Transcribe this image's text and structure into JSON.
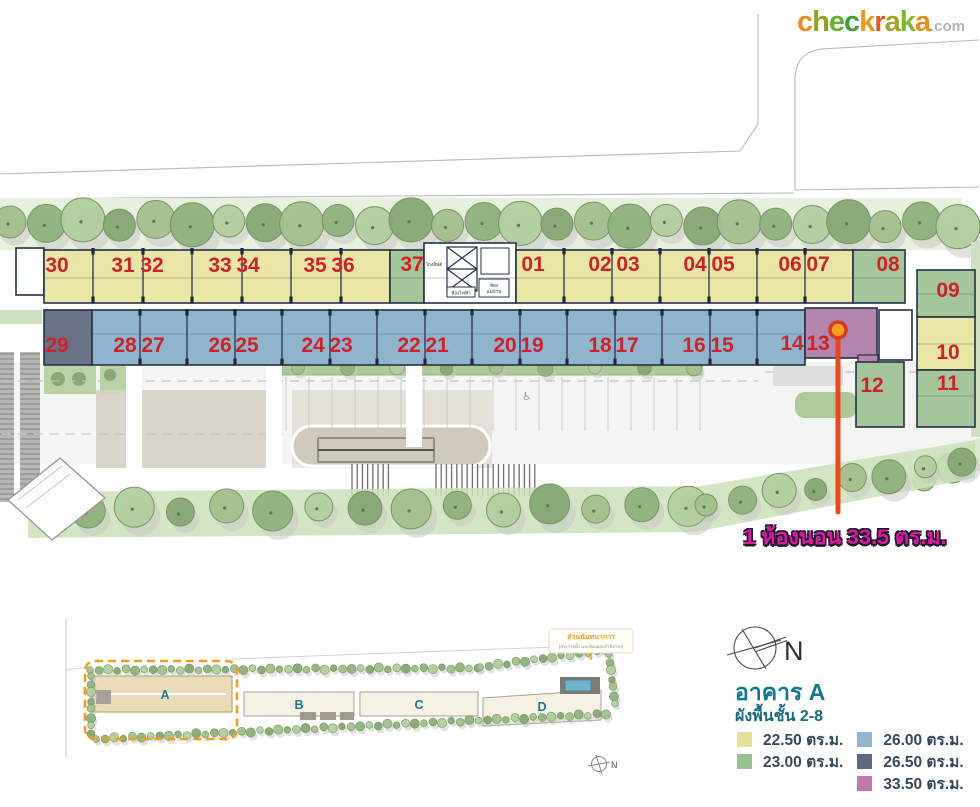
{
  "logo": {
    "letters": [
      "c",
      "h",
      "e",
      "c",
      "k",
      "r",
      "a",
      "k",
      "a"
    ],
    "suffix": ".com",
    "letter_colors": [
      "#ef8c1e",
      "#8fa31f",
      "#64b32a",
      "#3f9e3a",
      "#f0951c",
      "#e25a17",
      "#9aa822",
      "#7db82b",
      "#ee8d1c"
    ],
    "suffix_color": "#b5b5b5"
  },
  "plan": {
    "top_row_units": [
      "30",
      "31",
      "32",
      "33",
      "34",
      "35",
      "36",
      "37",
      "01",
      "02",
      "03",
      "04",
      "05",
      "06",
      "07",
      "08"
    ],
    "bottom_row_units": [
      "29",
      "28",
      "27",
      "26",
      "25",
      "24",
      "23",
      "22",
      "21",
      "20",
      "19",
      "18",
      "17",
      "16",
      "15",
      "14",
      "13"
    ],
    "right_units": [
      "09",
      "10",
      "11",
      "12"
    ],
    "core_labels": {
      "elevator_hall": "โถงลิฟต์",
      "electrical_room": "ห้องไฟฟ้า",
      "maid_room_line1": "ห้อง",
      "maid_room_line2": "แม่บ้าน"
    },
    "number_color": "#cf2127",
    "unit_sizes": {
      "22.50": [
        "30",
        "31",
        "32",
        "33",
        "34",
        "35",
        "36",
        "01",
        "02",
        "03",
        "04",
        "05",
        "06",
        "07",
        "10"
      ],
      "23.00": [
        "37",
        "08",
        "09",
        "11",
        "12"
      ],
      "26.00": [
        "28",
        "27",
        "26",
        "25",
        "24",
        "23",
        "22",
        "21",
        "20",
        "19",
        "18",
        "17",
        "16",
        "15",
        "14"
      ],
      "26.50": [
        "29"
      ],
      "33.50": [
        "13"
      ]
    }
  },
  "annotation": {
    "text": "1 ห้องนอน 33.5 ตร.ม.",
    "text_color": "#e0189c",
    "pointer_color": "#e8481c"
  },
  "overview": {
    "buildings": [
      "A",
      "B",
      "C",
      "D"
    ],
    "highlighted_building": "A",
    "highlight_color": "#f59d1c",
    "club_label": "ส่วนนันทนาการ",
    "club_sublabel": "(สระว่ายน้ำ และห้องออกกำลังกาย)",
    "compass_n": "N"
  },
  "info": {
    "compass_n": "N",
    "title": "อาคาร A",
    "subtitle": "ผังพื้นชั้น 2-8",
    "title_color": "#11798f",
    "legend": [
      {
        "label": "22.50 ตร.ม.",
        "color": "#e4e19b"
      },
      {
        "label": "23.00 ตร.ม.",
        "color": "#99bf93"
      },
      {
        "label": "26.00 ตร.ม.",
        "color": "#8fb8d0"
      },
      {
        "label": "26.50 ตร.ม.",
        "color": "#5f6880"
      },
      {
        "label": "33.50 ตร.ม.",
        "color": "#c379af"
      }
    ]
  }
}
